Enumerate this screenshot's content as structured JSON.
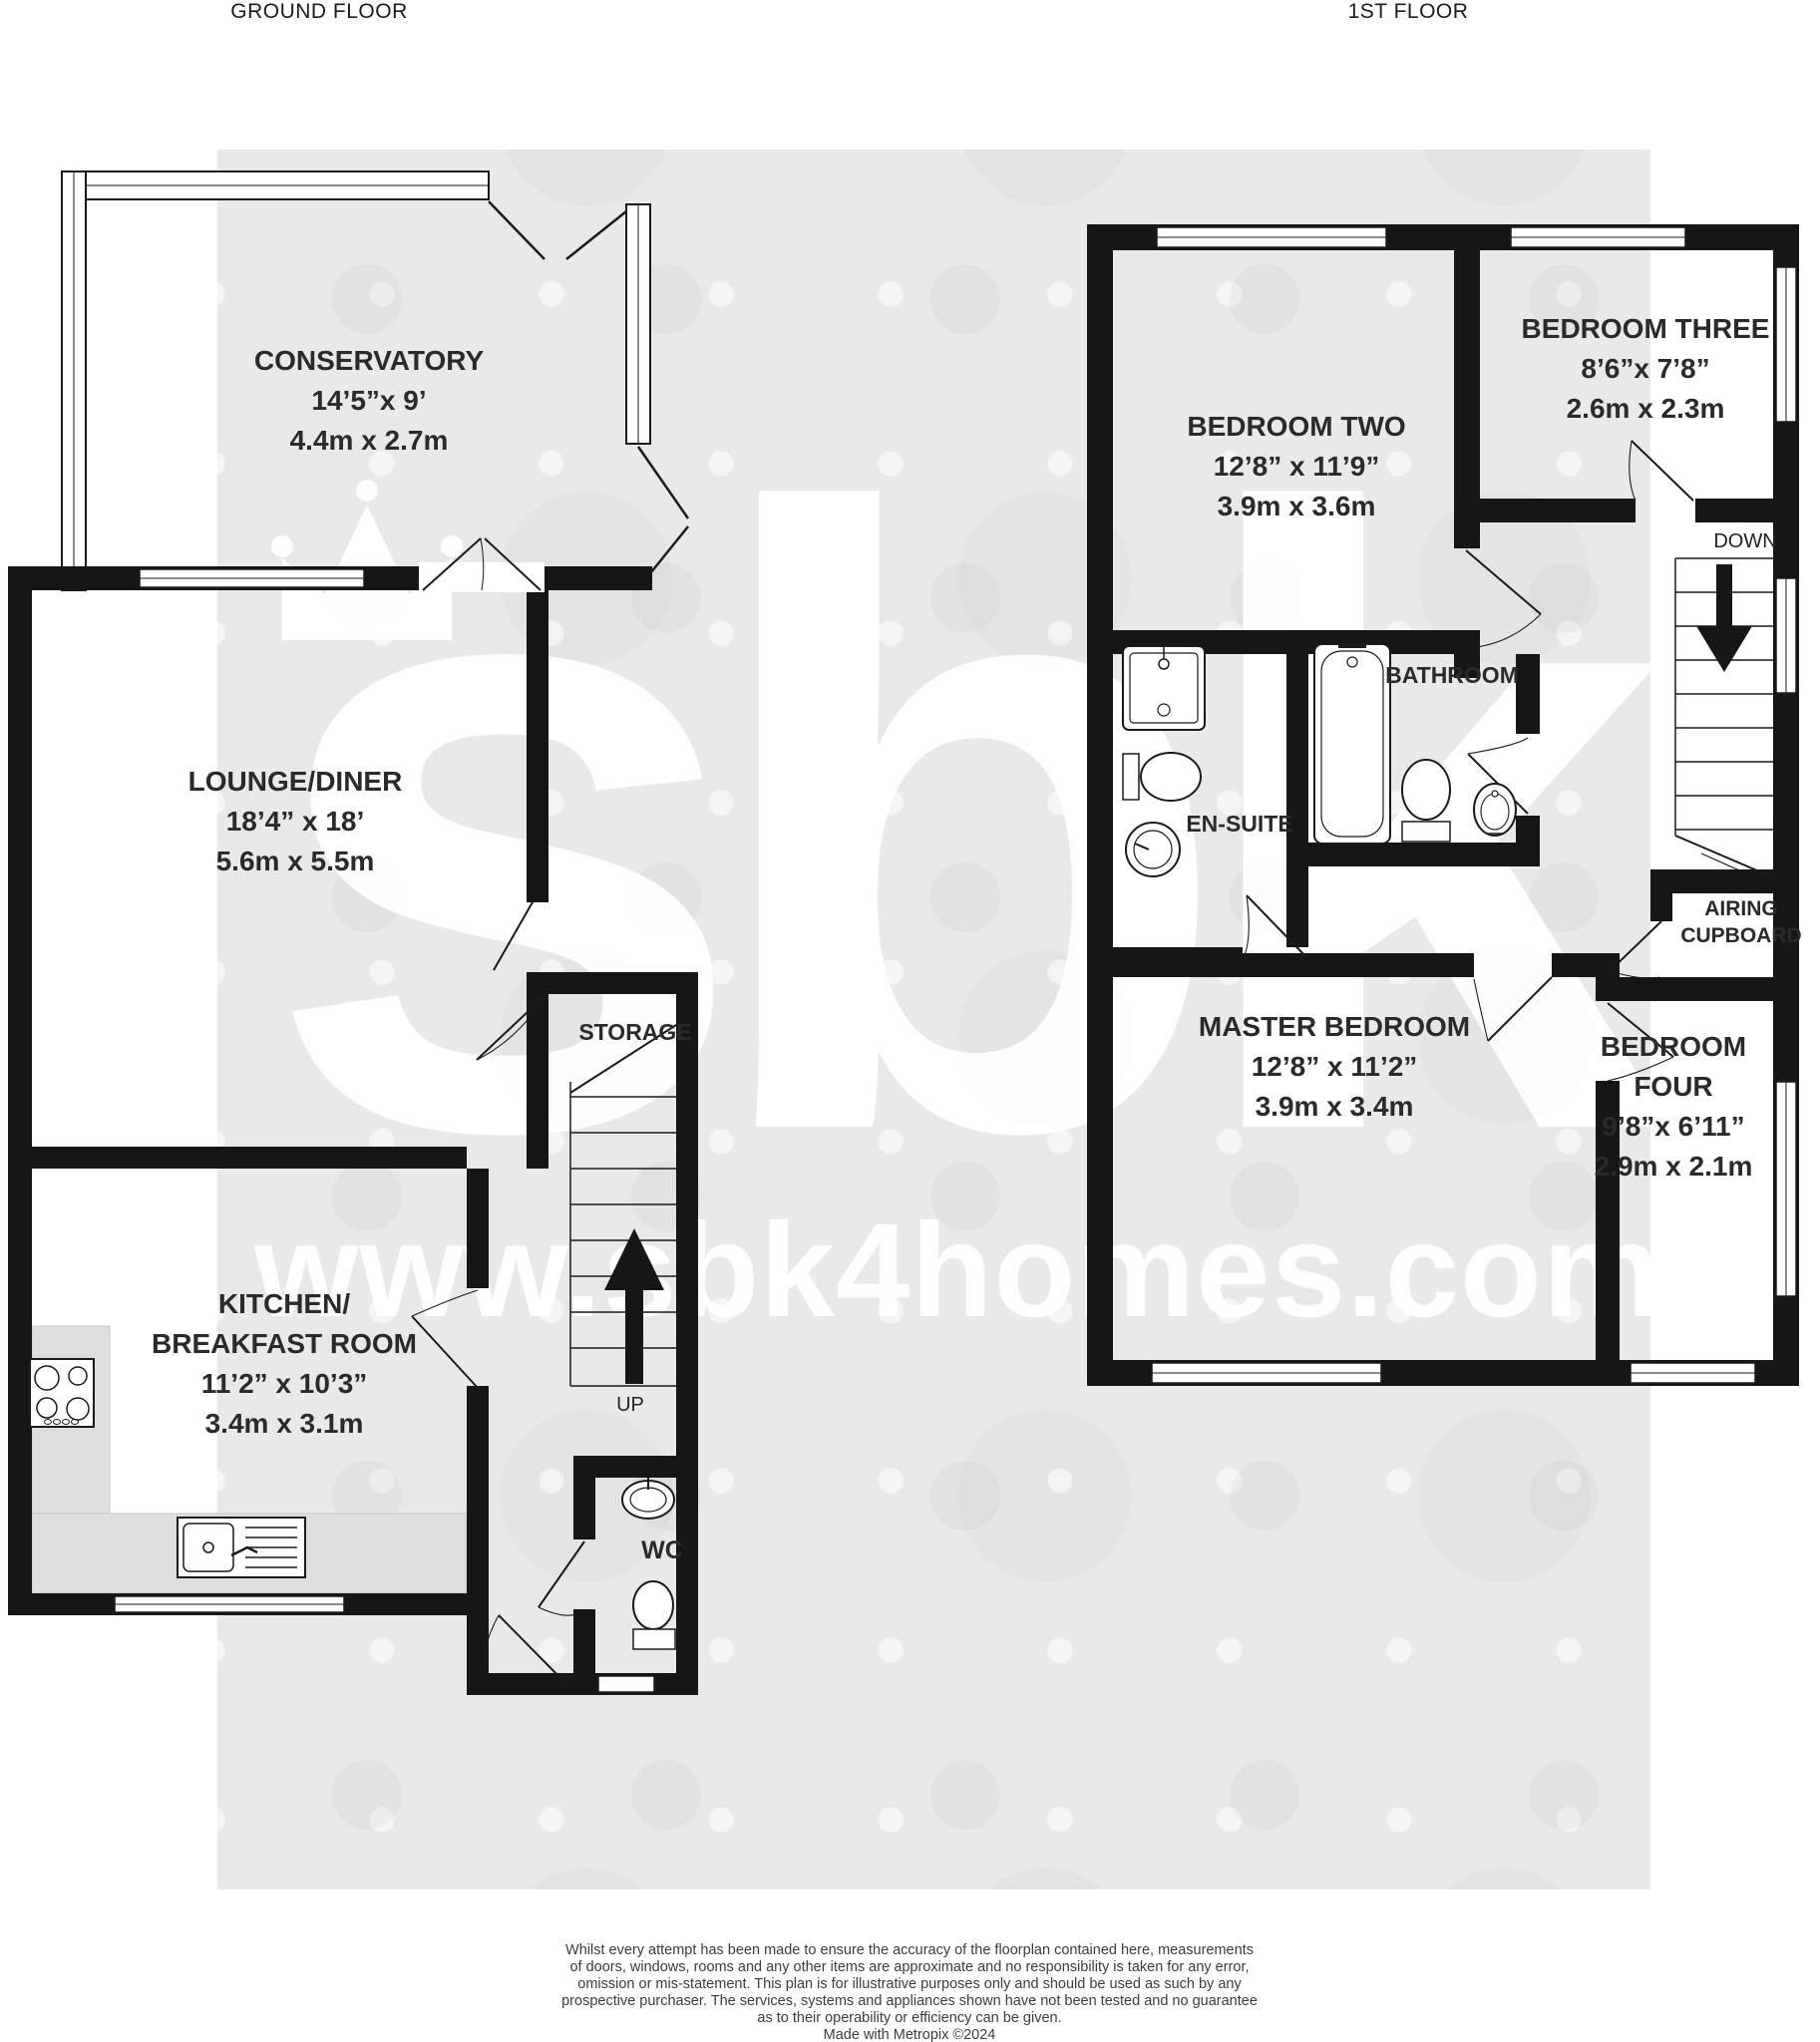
{
  "titles": {
    "ground": "GROUND FLOOR",
    "first": "1ST FLOOR"
  },
  "watermark": {
    "logo": "sbk",
    "url": "www.sbk4homes.com"
  },
  "ground_floor": {
    "conservatory": {
      "name": "CONSERVATORY",
      "imperial": "14’5”x 9’",
      "metric": "4.4m x 2.7m"
    },
    "lounge": {
      "name": "LOUNGE/DINER",
      "imperial": "18’4” x 18’",
      "metric": "5.6m x 5.5m"
    },
    "kitchen": {
      "name_line1": "KITCHEN/",
      "name_line2": "BREAKFAST ROOM",
      "imperial": "11’2” x 10’3”",
      "metric": "3.4m x 3.1m"
    },
    "storage": {
      "name": "STORAGE"
    },
    "wc": {
      "name": "WC"
    },
    "stairs": {
      "label": "UP"
    }
  },
  "first_floor": {
    "bedroom_two": {
      "name": "BEDROOM TWO",
      "imperial": "12’8” x 11’9”",
      "metric": "3.9m x 3.6m"
    },
    "bedroom_three": {
      "name": "BEDROOM THREE",
      "imperial": "8’6”x 7’8”",
      "metric": "2.6m x 2.3m"
    },
    "master_bedroom": {
      "name": "MASTER BEDROOM",
      "imperial": "12’8” x 11’2”",
      "metric": "3.9m x 3.4m"
    },
    "bedroom_four": {
      "name_line1": "BEDROOM",
      "name_line2": "FOUR",
      "imperial": "9’8”x 6’11”",
      "metric": "2.9m x 2.1m"
    },
    "bathroom": {
      "name": "BATHROOM"
    },
    "ensuite": {
      "name": "EN-SUITE"
    },
    "airing_cupboard": {
      "name_line1": "AIRING",
      "name_line2": "CUPBOARD"
    },
    "stairs": {
      "label": "DOWN"
    }
  },
  "footer": {
    "lines": [
      "Whilst every attempt has been made to ensure the accuracy of the floorplan contained here, measurements",
      "of doors, windows, rooms and any other items are approximate and no responsibility is taken for any error,",
      "omission or mis-statement. This plan is for illustrative purposes only and should be used as such by any",
      "prospective purchaser. The services, systems and appliances shown have not been tested and no guarantee",
      "as to their operability or efficiency can be given.",
      "Made with Metropix ©2024"
    ]
  }
}
